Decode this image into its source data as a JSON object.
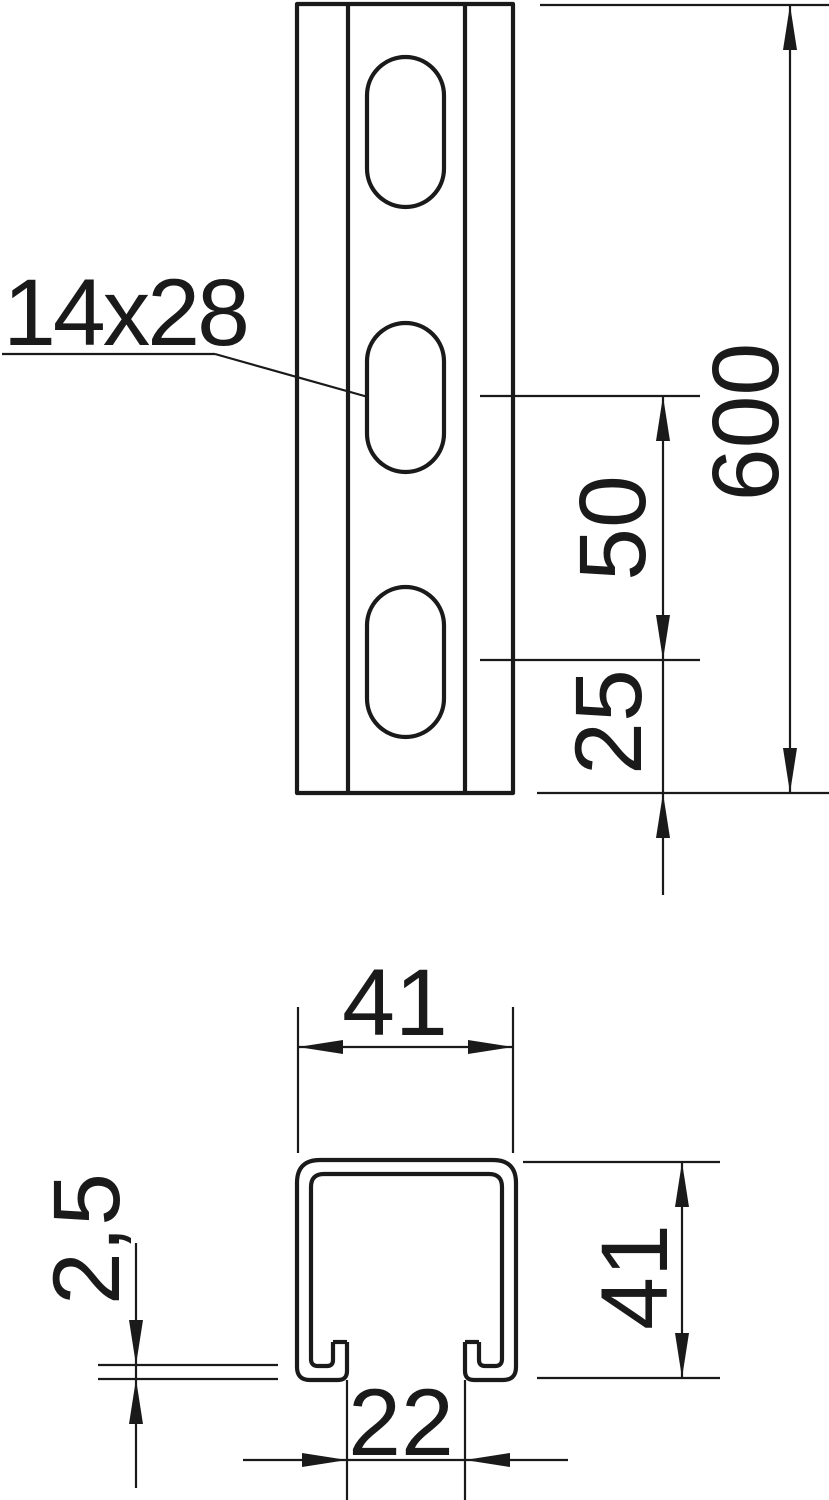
{
  "drawing": {
    "type": "technical-dimension-drawing",
    "part": "slotted strut channel rail",
    "front_view": {
      "slot_label": "14x28",
      "dim_total_length": "600",
      "dim_slot_pitch": "50",
      "dim_end_offset": "25",
      "slot_count_visible": 3
    },
    "section_view": {
      "dim_outer_width": "41",
      "dim_outer_height": "41",
      "dim_slot_opening": "22",
      "dim_material_thickness": "2,5"
    },
    "colors": {
      "line": "#1a1a1a",
      "background": "#ffffff"
    }
  }
}
